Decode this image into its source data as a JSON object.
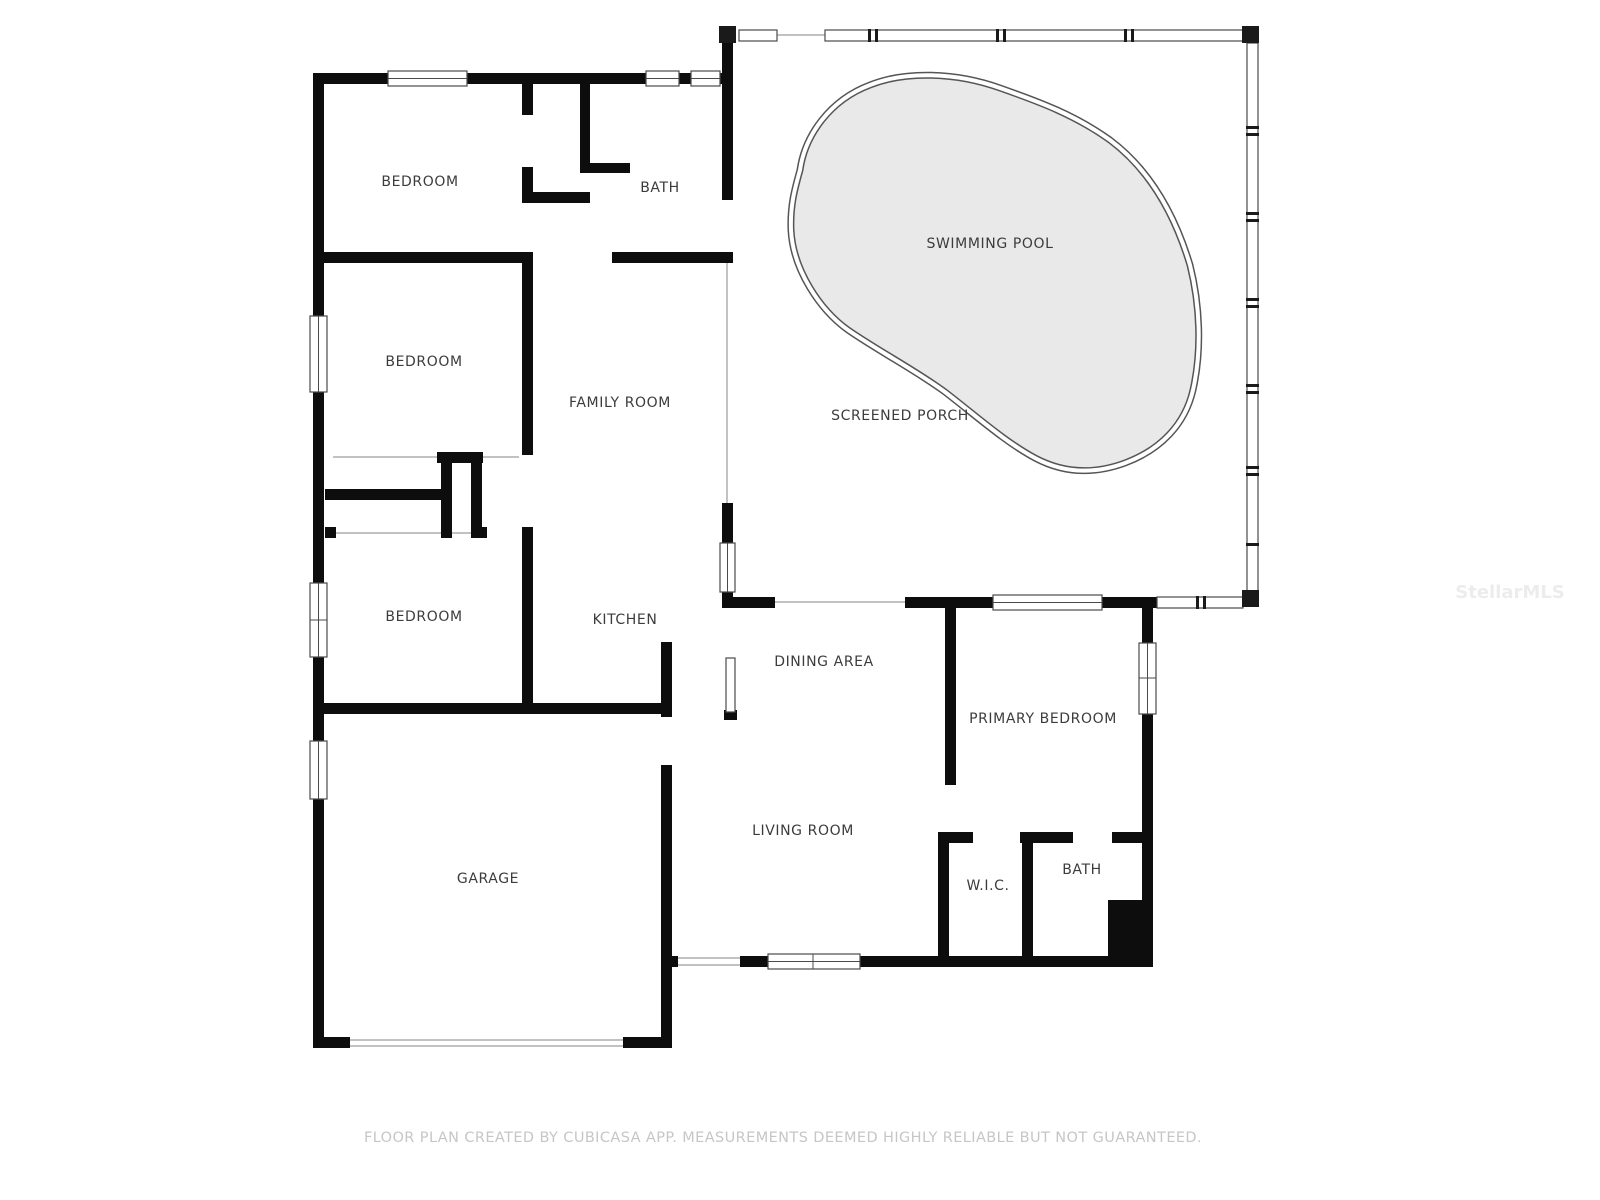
{
  "document": {
    "type": "floor-plan",
    "background_color": "#ffffff"
  },
  "floor_plan": {
    "rooms": [
      {
        "id": "bedroom-1",
        "label": "BEDROOM"
      },
      {
        "id": "bath-1",
        "label": "BATH"
      },
      {
        "id": "swimming-pool",
        "label": "SWIMMING POOL"
      },
      {
        "id": "bedroom-2",
        "label": "BEDROOM"
      },
      {
        "id": "family-room",
        "label": "FAMILY ROOM"
      },
      {
        "id": "screened-porch",
        "label": "SCREENED PORCH"
      },
      {
        "id": "bedroom-3",
        "label": "BEDROOM"
      },
      {
        "id": "kitchen",
        "label": "KITCHEN"
      },
      {
        "id": "dining-area",
        "label": "DINING AREA"
      },
      {
        "id": "primary-bedroom",
        "label": "PRIMARY BEDROOM"
      },
      {
        "id": "living-room",
        "label": "LIVING ROOM"
      },
      {
        "id": "wic",
        "label": "W.I.C."
      },
      {
        "id": "bath-2",
        "label": "BATH"
      },
      {
        "id": "garage",
        "label": "GARAGE"
      }
    ],
    "colors": {
      "wall": "#0d0d0d",
      "pool_fill": "#e9e9e9",
      "pool_outline": "#555555",
      "window_line": "#4a4a4a",
      "room_label": "#3c3c3c",
      "footer_text": "#c6c6c6",
      "watermark": "#ececec"
    }
  },
  "footer": {
    "text": "FLOOR PLAN CREATED BY CUBICASA APP. MEASUREMENTS DEEMED HIGHLY RELIABLE BUT NOT GUARANTEED."
  },
  "watermark": {
    "text": "StellarMLS"
  }
}
